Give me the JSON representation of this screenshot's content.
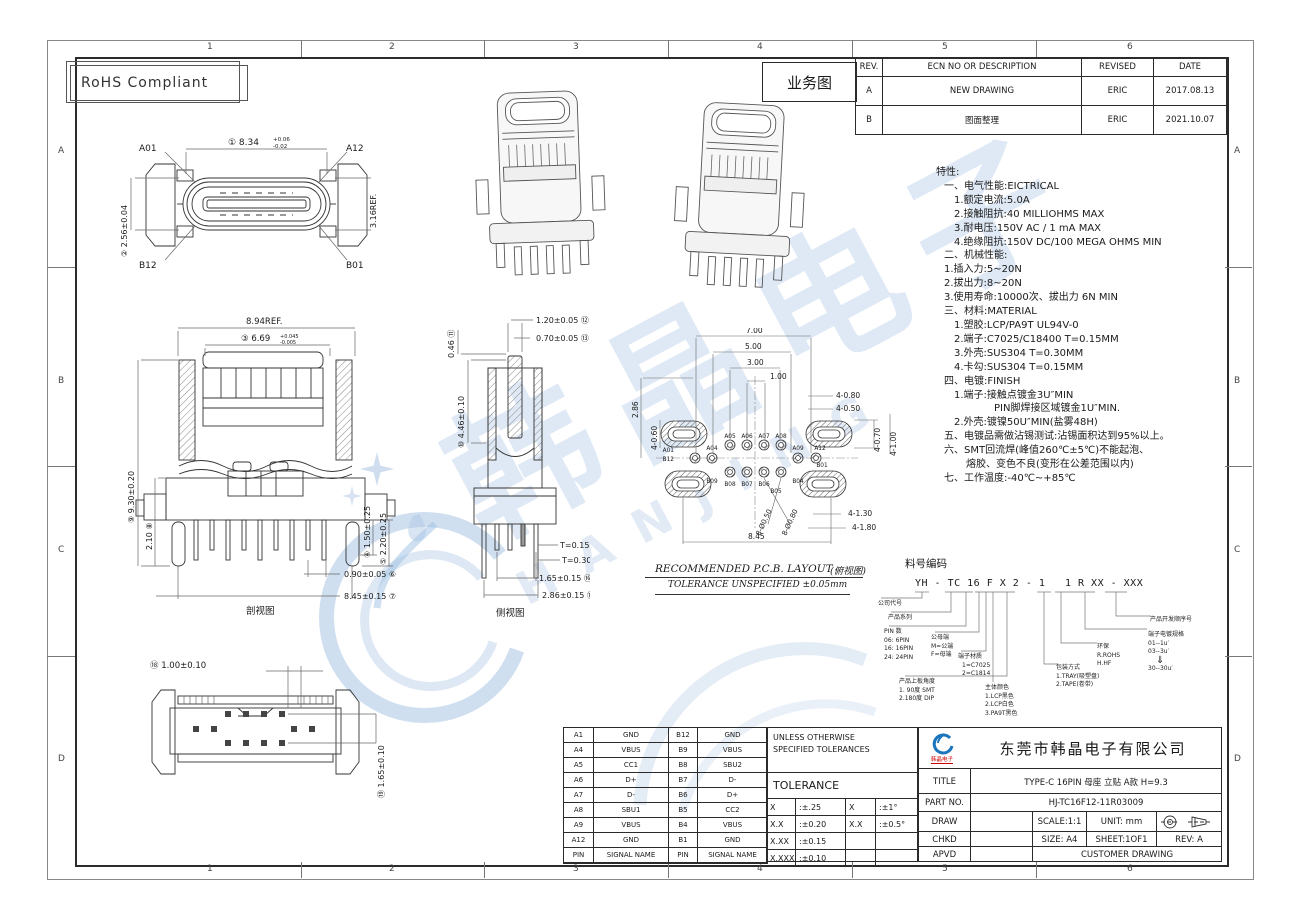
{
  "sheet": {
    "rohs_label": "RoHS Compliant",
    "zones_top": [
      "1",
      "2",
      "3",
      "4",
      "5",
      "6"
    ],
    "zones_bottom": [
      "1",
      "2",
      "3",
      "4",
      "5",
      "6"
    ],
    "zones_left": [
      "A",
      "B",
      "C",
      "D"
    ],
    "zones_right": [
      "A",
      "B",
      "C",
      "D"
    ],
    "watermark_cn": "韩晶电子",
    "watermark_en": "HANJING",
    "accent_blue": "#1b75bc",
    "watermark_blue": "#b9cfe6"
  },
  "revision_table": {
    "doc_label": "业务图",
    "headers": {
      "rev": "REV.",
      "desc": "ECN NO OR DESCRIPTION",
      "revised": "REVISED",
      "date": "DATE"
    },
    "rows": [
      {
        "rev": "A",
        "desc": "NEW DRAWING",
        "revised": "ERIC",
        "date": "2017.08.13"
      },
      {
        "rev": "B",
        "desc": "图面整理",
        "revised": "ERIC",
        "date": "2021.10.07"
      }
    ]
  },
  "specs": {
    "lines": [
      "特性:",
      "一、电气性能:EICTRICAL",
      "1.额定电流:5.0A",
      "2.接触阻抗:40 MILLIOHMS MAX",
      "3.耐电压:150V AC / 1 mA MAX",
      "4.绝缘阻抗:150V DC/100 MEGA OHMS MIN",
      "二、机械性能:",
      "1.插入力:5~20N",
      "2.拔出力:8~20N",
      "3.使用寿命:10000次、拔出力 6N MIN",
      "三、材料:MATERIAL",
      "1.塑胶:LCP/PA9T UL94V-0",
      "2.端子:C7025/C18400 T=0.15MM",
      "3.外壳:SUS304 T=0.30MM",
      "4.卡勾:SUS304 T=0.15MM",
      "四、电镀:FINISH",
      "1.端子:接触点镀金3U″MIN",
      "PIN脚焊接区域镀金1U″MIN.",
      "2.外壳:镀镍50U″MIN(盐雾48H)",
      "五、电镀品需做沾锡测试:沾锡面积达到95%以上。",
      "六、SMT回流焊(峰值260℃±5℃)不能起泡、",
      "熔胶、变色不良(变形在公差范围以内)",
      "七、工作温度:-40℃~+85℃"
    ]
  },
  "views": {
    "front": {
      "a01": "A01",
      "a12": "A12",
      "b12": "B12",
      "b01": "B01",
      "d1": "① 8.34",
      "d1up": "+0.06",
      "d1dn": "-0.02",
      "d2": "② 2.56±0.04",
      "d3": "3.16REF."
    },
    "section": {
      "caption": "剖视图",
      "ref": "8.94REF.",
      "d3": "③ 6.69",
      "d3up": "+0.045",
      "d3dn": "-0.005",
      "d9": "⑨ 9.30±0.20",
      "d8": "2.10 ⑧",
      "d4": "④ 1.50±0.25",
      "d5": "⑤ 2.20±0.25",
      "d6": "0.90±0.05 ⑥",
      "d7": "8.45±0.15 ⑦"
    },
    "side": {
      "caption": "侧视图",
      "d11": "0.46 ⑪",
      "d12": "1.20±0.05 ⑫",
      "d13": "0.70±0.05 ⑬",
      "d10": "⑩ 4.46±0.10",
      "d14": "T=0.15 ⑭",
      "d15": "T=0.30 ⑮",
      "d16": "1.65±0.15 ⑯",
      "d17": "2.86±0.15 ⑰"
    },
    "bottom": {
      "d18": "⑱ 1.00±0.10",
      "d19": "⑲ 1.65±0.10"
    },
    "pcb": {
      "caption": "RECOMMENDED   P.C.B.  LAYOUT",
      "caption_cn": "(俯视图)",
      "note": "TOLERANCE  UNSPECIFIED  ±0.05mm",
      "d700": "7.00",
      "d500": "5.00",
      "d300": "3.00",
      "d100": "1.00",
      "d480": "4-0.80",
      "d450": "4-0.50",
      "d286": "2.86",
      "d460": "4-0.60",
      "d470": "4-0.70",
      "d4100": "4-1.00",
      "d4130": "4-1.30",
      "d4180": "4-1.80",
      "d845": "8.45",
      "h50": "8-Ø0.50",
      "h80": "8-Ø0.80",
      "pads": {
        "a01": "A01",
        "b12": "B12",
        "a04": "A04",
        "b09": "B09",
        "a05": "A05",
        "a06": "A06",
        "a07": "A07",
        "a08": "A08",
        "b08": "B08",
        "b07": "B07",
        "b06": "B06",
        "b05": "B05",
        "a09": "A09",
        "b04": "B04",
        "a12": "A12",
        "b01": "B01"
      }
    }
  },
  "part_code": {
    "header": "料号编码",
    "code": "YH - TC 16 F X 2 - 1   1 R XX - XXX",
    "callouts": {
      "c1": {
        "title": "公司代号"
      },
      "c2": {
        "title": "产品系列"
      },
      "c3": {
        "title": "PIN 数",
        "o1": "06: 6PIN",
        "o2": "16: 16PIN",
        "o3": "24: 24PIN"
      },
      "c4": {
        "title": "公母端",
        "o1": "M=公端",
        "o2": "F=母端"
      },
      "c5": {
        "title": "端子材质",
        "o1": "1=C7025",
        "o2": "2=C1814"
      },
      "c6": {
        "title": "产品上板角度",
        "o1": "1. 90度 SMT",
        "o2": "2.180度 DIP"
      },
      "c7": {
        "title": "主体颜色",
        "o1": "1.LCP黑色",
        "o2": "2.LCP白色",
        "o3": "3.PA9T黑色"
      },
      "c8": {
        "title": "包装方式",
        "o1": "1.TRAY(吸塑盘)",
        "o2": "2.TAPE(卷带)"
      },
      "c9": {
        "title": "环保",
        "o1": "R.ROHS",
        "o2": "H.HF"
      },
      "c10": {
        "title": "端子电镀规格",
        "o1": "01--1u′",
        "o2": "03--3u′",
        "o3": "⇓",
        "o4": "30--30u′"
      },
      "c11": {
        "title": "产品开发顺序号"
      }
    }
  },
  "pin_table": {
    "rows": [
      [
        "A1",
        "GND",
        "B12",
        "GND"
      ],
      [
        "A4",
        "VBUS",
        "B9",
        "VBUS"
      ],
      [
        "A5",
        "CC1",
        "B8",
        "SBU2"
      ],
      [
        "A6",
        "D+",
        "B7",
        "D-"
      ],
      [
        "A7",
        "D-",
        "B6",
        "D+"
      ],
      [
        "A8",
        "SBU1",
        "B5",
        "CC2"
      ],
      [
        "A9",
        "VBUS",
        "B4",
        "VBUS"
      ],
      [
        "A12",
        "GND",
        "B1",
        "GND"
      ],
      [
        "PIN",
        "SIGNAL NAME",
        "PIN",
        "SIGNAL NAME"
      ]
    ]
  },
  "tolerance_table": {
    "note1": "UNLESS OTHERWISE",
    "note2": "SPECIFIED TOLERANCES",
    "title": "TOLERANCE",
    "rows": [
      [
        "X",
        ":±.25",
        "X",
        ":±1°"
      ],
      [
        "X.X",
        ":±0.20",
        "X.X",
        ":±0.5°"
      ],
      [
        "X.XX",
        ":±0.15",
        "",
        ""
      ],
      [
        "X.XXX",
        ":±0.10",
        "",
        ""
      ]
    ]
  },
  "title_block": {
    "company": "东莞市韩晶电子有限公司",
    "logo_text": "韩晶电子",
    "title_label": "TITLE",
    "title_value": "TYPE-C 16PIN 母座 立贴 A款 H=9.3",
    "partno_label": "PART NO.",
    "partno_value": "HJ-TC16F12-11R03009",
    "draw_label": "DRAW",
    "chkd_label": "CHKD",
    "apvd_label": "APVD",
    "scale": "SCALE:1:1",
    "unit": "UNIT:  mm",
    "size": "SIZE:  A4",
    "sheet": "SHEET:1OF1",
    "rev": "REV:  A",
    "customer": "CUSTOMER DRAWING"
  }
}
